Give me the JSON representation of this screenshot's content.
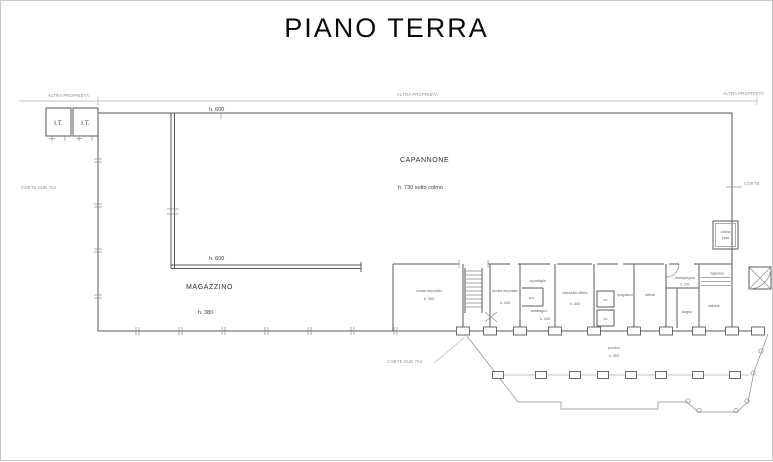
{
  "title": "PIANO TERRA",
  "colors": {
    "ink": "#5a5a5a",
    "faint": "#b0b0b0",
    "title": "#0b0b0b"
  },
  "boundary": {
    "altra_left": "ALTRA PROPRIETA'",
    "altra_center": "ALTRA PROPRIETA'",
    "altra_right": "ALTRA PROPRIETA'",
    "corte_left": "CORTE SUB 704",
    "corte_bottom": "CORTE SUB 704",
    "corte_right": "CORTE"
  },
  "it_rooms": {
    "left": "I.T.",
    "right": "I.T."
  },
  "capannone": {
    "name": "CAPANNONE",
    "height": "h. 730 sotto colmo",
    "beam_top": "h. 600",
    "beam_mid": "h. 600"
  },
  "magazzino": {
    "name": "MAGAZZINO",
    "height": "h. 380"
  },
  "wing": {
    "deposito1": {
      "name": "locale deposito",
      "h": "h. 300"
    },
    "deposito2": {
      "name": "locale deposito",
      "h": "h. 240"
    },
    "ripostiglio": "ripostiglio",
    "wc_small": "w.c.",
    "antibagno": {
      "name": "antibagno",
      "h": "h. 240"
    },
    "dep_ufficio": {
      "name": "deposito ufficio",
      "h": "h. 300"
    },
    "wc_a": "wc",
    "wc_b": "wc",
    "spogliatoio": "spogliatoio",
    "ufficio": "ufficio",
    "disimpegno": {
      "name": "disimpegno",
      "h": "h. 240"
    },
    "bagno": "bagno",
    "ingresso": "ingresso",
    "salone": "salone",
    "cabina": {
      "line1": "cabina",
      "line2": "pesa"
    }
  },
  "portico": {
    "name": "portico",
    "h": "h. 300"
  }
}
